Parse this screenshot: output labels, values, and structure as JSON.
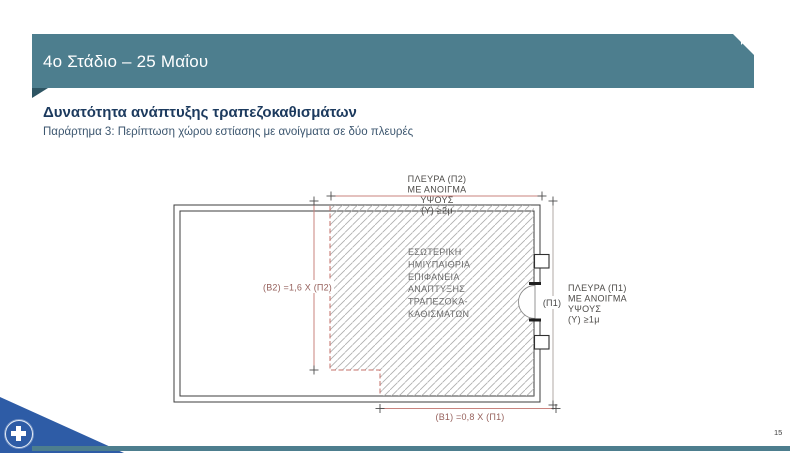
{
  "header": {
    "title": "4ο Στάδιο – 25 Μαΐου"
  },
  "content": {
    "title": "Δυνατότητα ανάπτυξης τραπεζοκαθισμάτων",
    "subtitle": "Παράρτημα 3: Περίπτωση χώρου εστίασης με ανοίγματα σε δύο πλευρές"
  },
  "diagram": {
    "side_p2_label": {
      "lines": [
        "ΠΛΕΥΡΑ (Π2)",
        "ΜΕ ΑΝΟΙΓΜΑ",
        "ΥΨΟΥΣ",
        "(Υ) ≥2μ"
      ]
    },
    "side_p1_label": {
      "lines": [
        "ΠΛΕΥΡΑ (Π1)",
        "ΜΕ ΑΝΟΙΓΜΑ",
        "ΥΨΟΥΣ",
        "(Υ) ≥1μ"
      ]
    },
    "area_label": {
      "lines": [
        "ΕΣΩΤΕΡΙΚΗ",
        "ΗΜΙΥΠΑΙΘΡΙΑ",
        "ΕΠΙΦΑΝΕΙΑ",
        "ΑΝΑΠΤΥΞΗΣ",
        "ΤΡΑΠΕΖΟΚΑ-",
        "ΚΑΘΙΣΜΑΤΩΝ"
      ]
    },
    "dim_b2": "(Β2) =1,6 Χ (Π2)",
    "dim_b1": "(Β1) =0,8 Χ (Π1)",
    "dim_p1": "(Π1)"
  },
  "footer": {
    "page_number": "15"
  },
  "colors": {
    "header_teal": "#4d7e8e",
    "header_fold_dark": "#2e5563",
    "title_navy": "#1c3a5e",
    "dimension_line_red": "#c9837e",
    "dashed_boundary_red": "#c4706a",
    "dimension_label_red": "#96615c",
    "logo_blue": "#2e5ca6"
  }
}
